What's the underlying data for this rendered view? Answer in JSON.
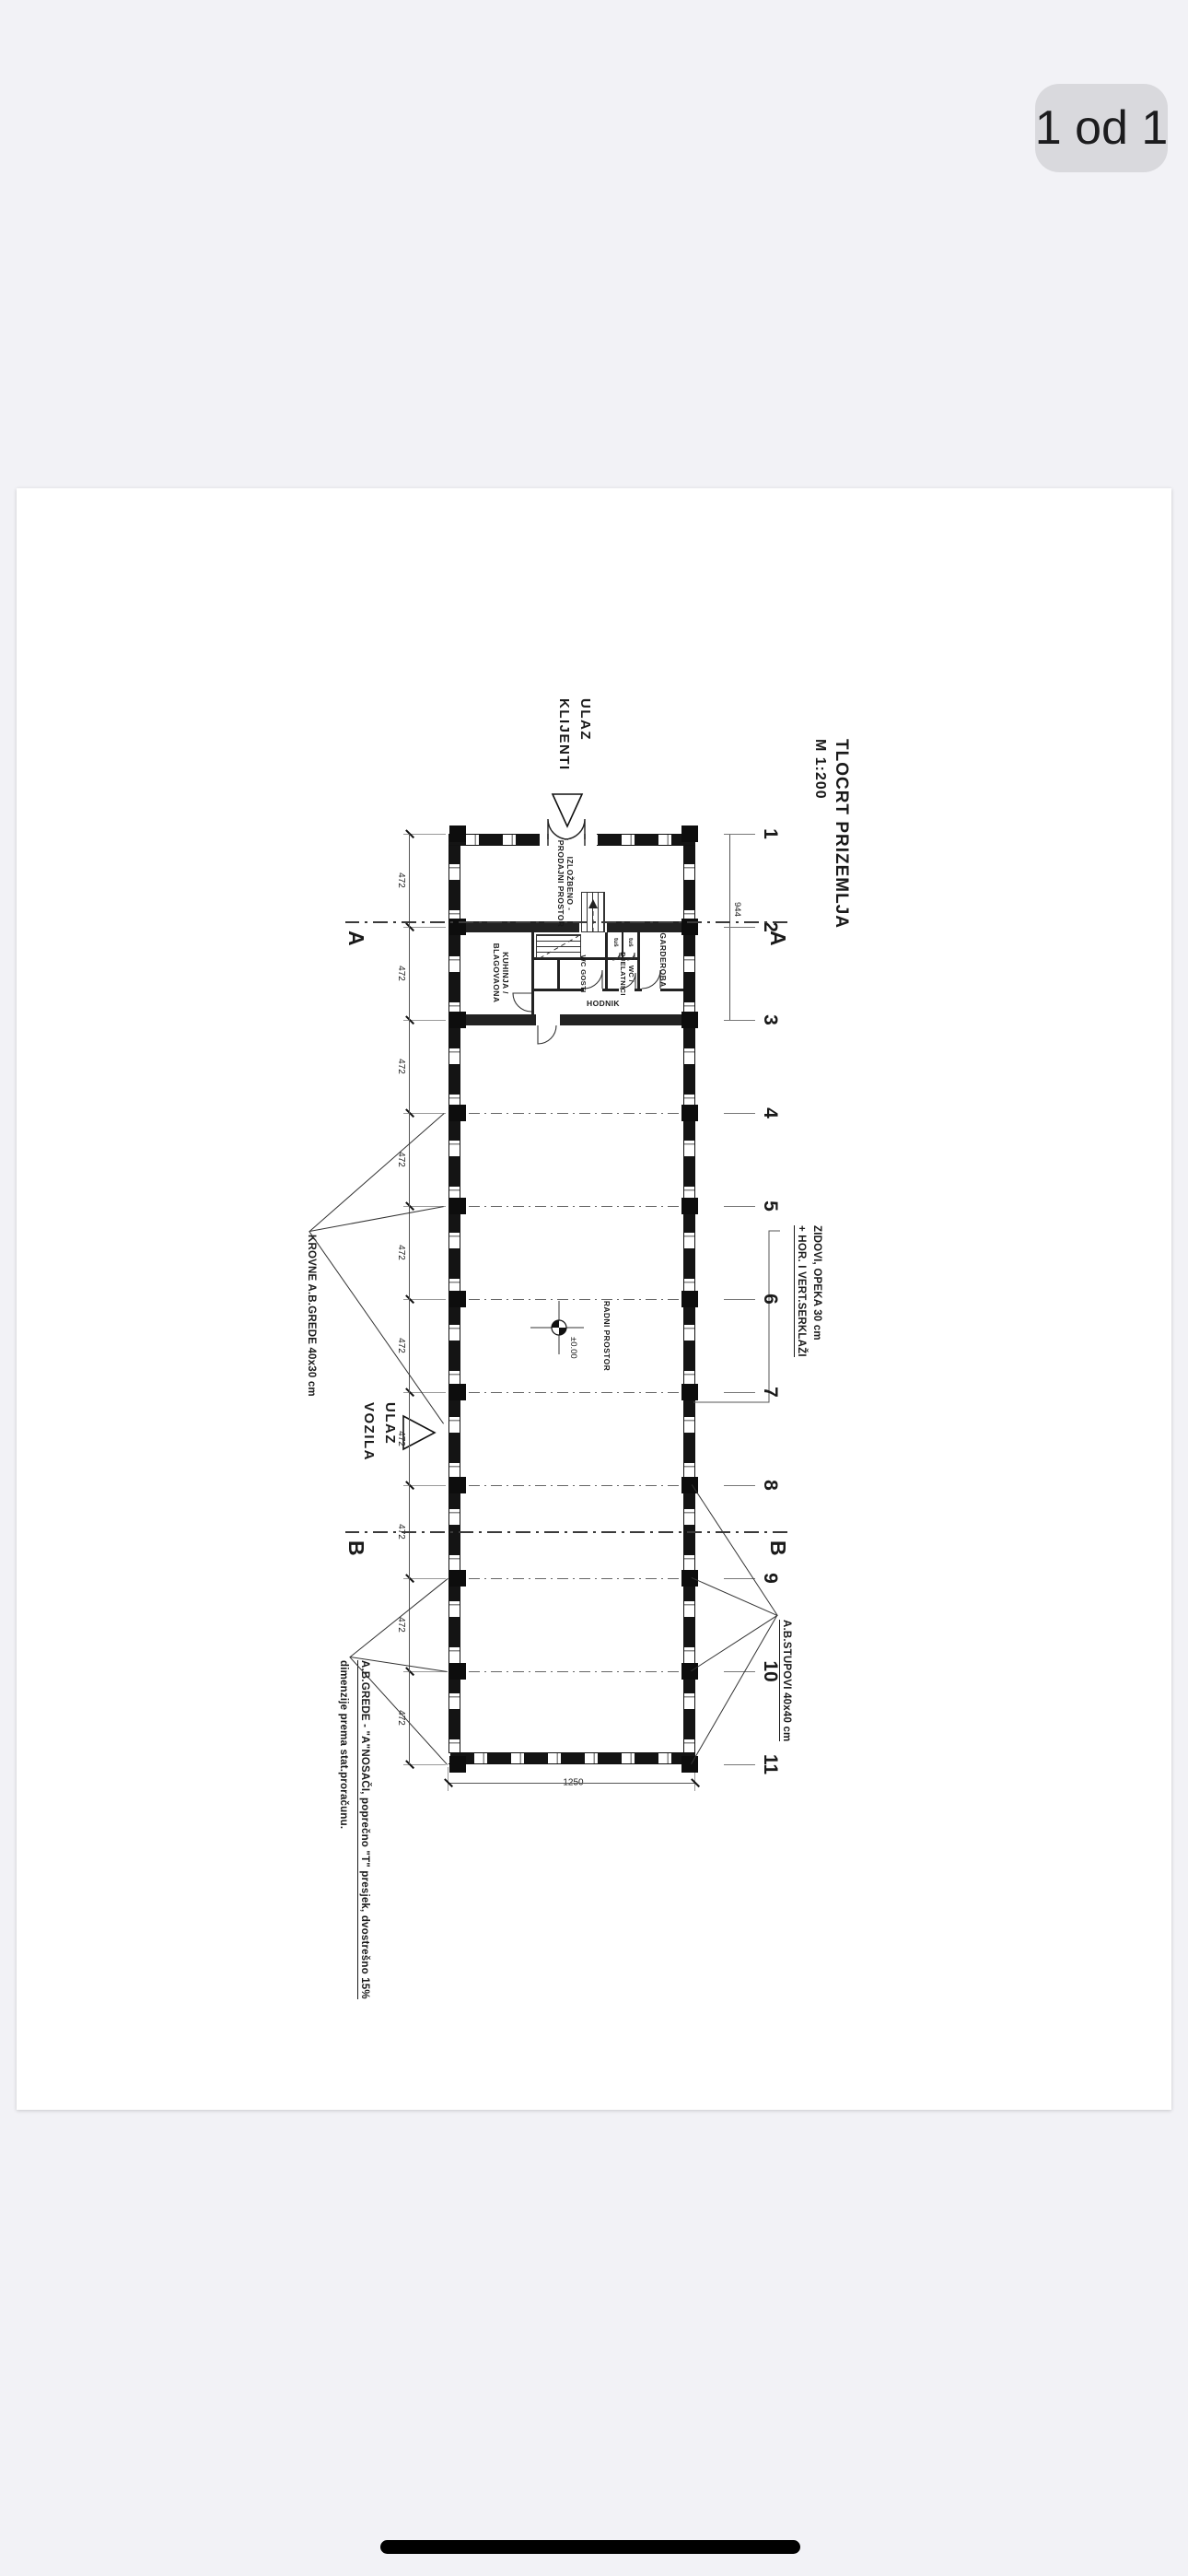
{
  "viewer": {
    "page_indicator": "1 od 1"
  },
  "plan": {
    "title": "TLOCRT PRIZEMLJA",
    "scale": "M 1:200",
    "grid_numbers": [
      "1",
      "2",
      "3",
      "4",
      "5",
      "6",
      "7",
      "8",
      "9",
      "10",
      "11"
    ],
    "section_markers": [
      "A",
      "B"
    ],
    "bay_dims": [
      "472",
      "472",
      "472",
      "472",
      "472",
      "472",
      "472",
      "472",
      "472",
      "472"
    ],
    "dim_grid1_3": "944",
    "overall_width": "1250",
    "entrance_client_line1": "ULAZ",
    "entrance_client_line2": "KLIJENTI",
    "entrance_vehicle_line1": "ULAZ",
    "entrance_vehicle_line2": "VOZILA",
    "rooms": {
      "showroom1": "IZLOŽBENO -",
      "showroom2": "PRODAJNI PROSTOR",
      "kitchen1": "KUHINJA /",
      "kitchen2": "BLAGOVAONA",
      "wc_guests": "WC GOSTI",
      "wc_staff1": "WC /",
      "wc_staff2": "DJELATNICI",
      "wardrobe": "GARDEROBA",
      "corridor": "HODNIK",
      "shower": "tuš",
      "hall": "RADNI PROSTOR"
    },
    "level": "±0.00",
    "annotations": {
      "roof_beams": "KROVNE A.B.GREDE 40x30 cm",
      "walls_line1": "ZIDOVI, OPEKA 30 cm",
      "walls_line2": "+ HOR. I VERT.SERKLAŽI",
      "columns": "A.B.STUPOVI 40x40 cm",
      "beams_line1": "A.B.GREDE - \"A\"NOSAČI, poprečno \"T\" presjek, dvostrešno 15%",
      "beams_line2": "dimenzije prema stat.proračunu."
    },
    "colors": {
      "background": "#f2f2f6",
      "badge": "#d9d9dd",
      "line": "#1a1a1a"
    }
  }
}
